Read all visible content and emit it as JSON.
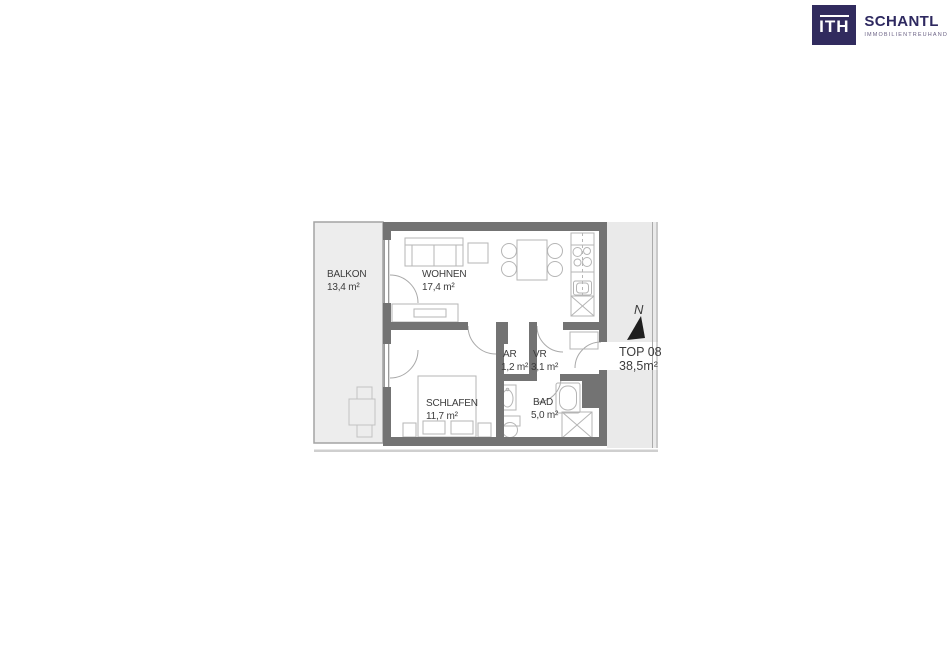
{
  "logo": {
    "mark": "ITH",
    "company": "SCHANTL",
    "subtitle": "IMMOBILIENTREUHAND"
  },
  "plan": {
    "rooms": [
      {
        "id": "balkon",
        "name": "BALKON",
        "area": "13,4 m²"
      },
      {
        "id": "wohnen",
        "name": "WOHNEN",
        "area": "17,4 m²"
      },
      {
        "id": "schlafen",
        "name": "SCHLAFEN",
        "area": "11,7 m²"
      },
      {
        "id": "ar",
        "name": "AR",
        "area": "1,2 m²"
      },
      {
        "id": "vr",
        "name": "VR",
        "area": "3,1 m²"
      },
      {
        "id": "bad",
        "name": "BAD",
        "area": "5,0 m²"
      }
    ],
    "unit": {
      "label": "TOP 08",
      "area": "38,5m²"
    },
    "compass": {
      "label": "N"
    }
  },
  "colors": {
    "wall": "#737373",
    "balcony_fill": "#ededed",
    "corridor_fill": "#eaeaea",
    "furniture_stroke": "#b5b5b5",
    "door_arc": "#a9a9a9",
    "label_text": "#3c3c3c",
    "logo_navy": "#312b5e",
    "compass_arrow": "#1e1e1e"
  }
}
